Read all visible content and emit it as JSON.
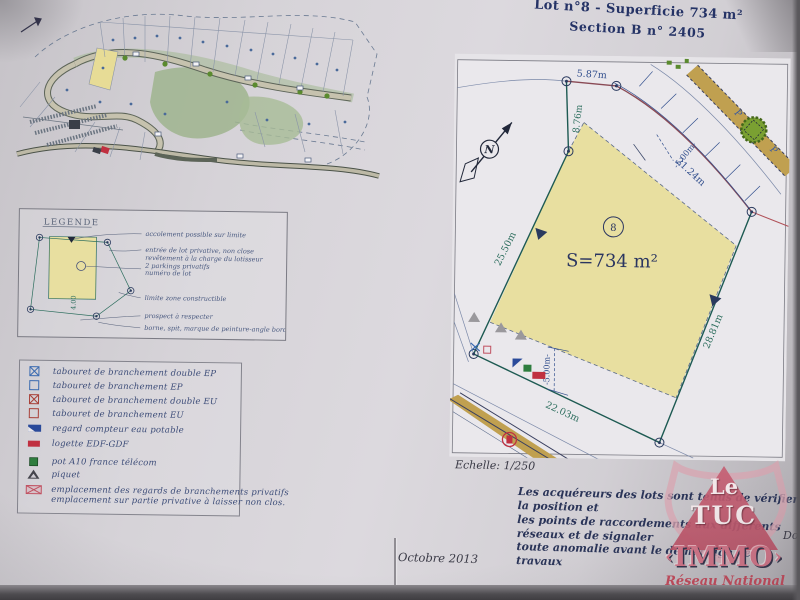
{
  "header": {
    "line1": "Lot n°8  - Superficie 734 m²",
    "line2": "Section B  n° 2405"
  },
  "legende": {
    "title": "LEGENDE",
    "diagram_dim": "4.00",
    "labels": [
      "accolement possible sur limite",
      "entrée de lot privative, non close",
      "revêtement à la charge du lotisseur",
      "2 parkings privatifs",
      "numéro de lot",
      "limite zone constructible",
      "prospect à respecter",
      "borne, spit, marque de peinture-angle bordures-parpaings"
    ]
  },
  "symbols_legend": {
    "items": [
      {
        "icon": "square-x-blue",
        "label": "tabouret de branchement double EP"
      },
      {
        "icon": "square-blue",
        "label": "tabouret de branchement EP"
      },
      {
        "icon": "square-x-red",
        "label": "tabouret de branchement double EU"
      },
      {
        "icon": "square-red",
        "label": "tabouret de branchement EU"
      },
      {
        "icon": "water-meter",
        "label": "regard compteur eau potable"
      },
      {
        "icon": "edf-box",
        "label": "logette EDF-GDF"
      },
      {
        "icon": "telecom-pot",
        "label": "pot A10 france télécom"
      },
      {
        "icon": "stake",
        "label": "piquet"
      },
      {
        "icon": "hatched-box",
        "label": "emplacement des regards de branchements privatifs"
      },
      {
        "icon": "none",
        "label": "emplacement sur partie privative à laisser non clos."
      }
    ]
  },
  "plan": {
    "scale_label": "Echelle: 1/250",
    "area_label": "S=734 m²",
    "lot_number": "8",
    "north_letter": "N",
    "parking_letter": "P",
    "dim_top": "5.87m",
    "dim_left_upper": "8.76m",
    "dim_road": "21.24m",
    "dim_left": "25.50m",
    "dim_right": "28.81m",
    "dim_bottom": "22.03m",
    "dim_setback_top": "-5.00m-",
    "dim_setback_bottom": "-5.00m-"
  },
  "notice": {
    "line1": "Les acquéreurs des lots sont tenus de vérifier la position et",
    "line2": "les points de raccordements aux différents réseaux et de signaler",
    "line3": "toute anomalie avant le démarrage des travaux"
  },
  "footer": {
    "date": "Octobre 2013",
    "right_partial": "Dos"
  },
  "logo": {
    "top": "Le",
    "mid": "TUC",
    "banner": "IMMO",
    "bottom": "Réseau National"
  },
  "colors": {
    "accent_navy": "#2a3560",
    "accent_teal": "#2d6e5e",
    "accent_blue": "#33508e",
    "accent_red": "#b53545",
    "lot_yellow": "#e8dfa0",
    "road_tan": "#c0a050",
    "logo_pink": "#c66478"
  }
}
